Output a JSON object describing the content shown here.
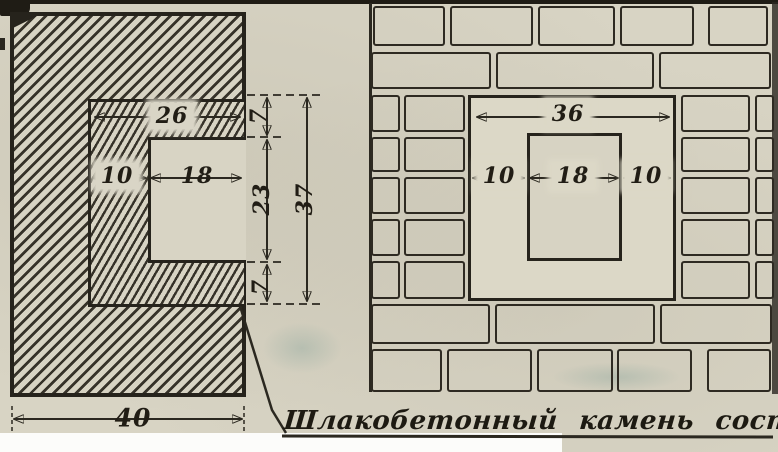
{
  "figure": {
    "kind": "scanned technical drawing, two wall sections",
    "caption": "Шлакобетонный камень состава 1:7."
  },
  "left_figure": {
    "description": "hatched corner section of wall with slag-concrete lining",
    "dims": {
      "lining_top_width": "26",
      "lining_thickness": "10",
      "channel_width": "18",
      "band_top": "7",
      "channel_height": "23",
      "band_bottom": "7",
      "total_inner_height": "37",
      "block_width": "40"
    }
  },
  "right_figure": {
    "description": "brick masonry plan with central flue opening",
    "dims": {
      "inner_span": "36",
      "left_offset": "10",
      "hole_width": "18",
      "right_offset": "10"
    }
  },
  "colors": {
    "paper": "#d8d4c4",
    "ink": "#2b2820",
    "paper_bright": "#dcd8c7",
    "white_margin": "#fcfcfa"
  }
}
